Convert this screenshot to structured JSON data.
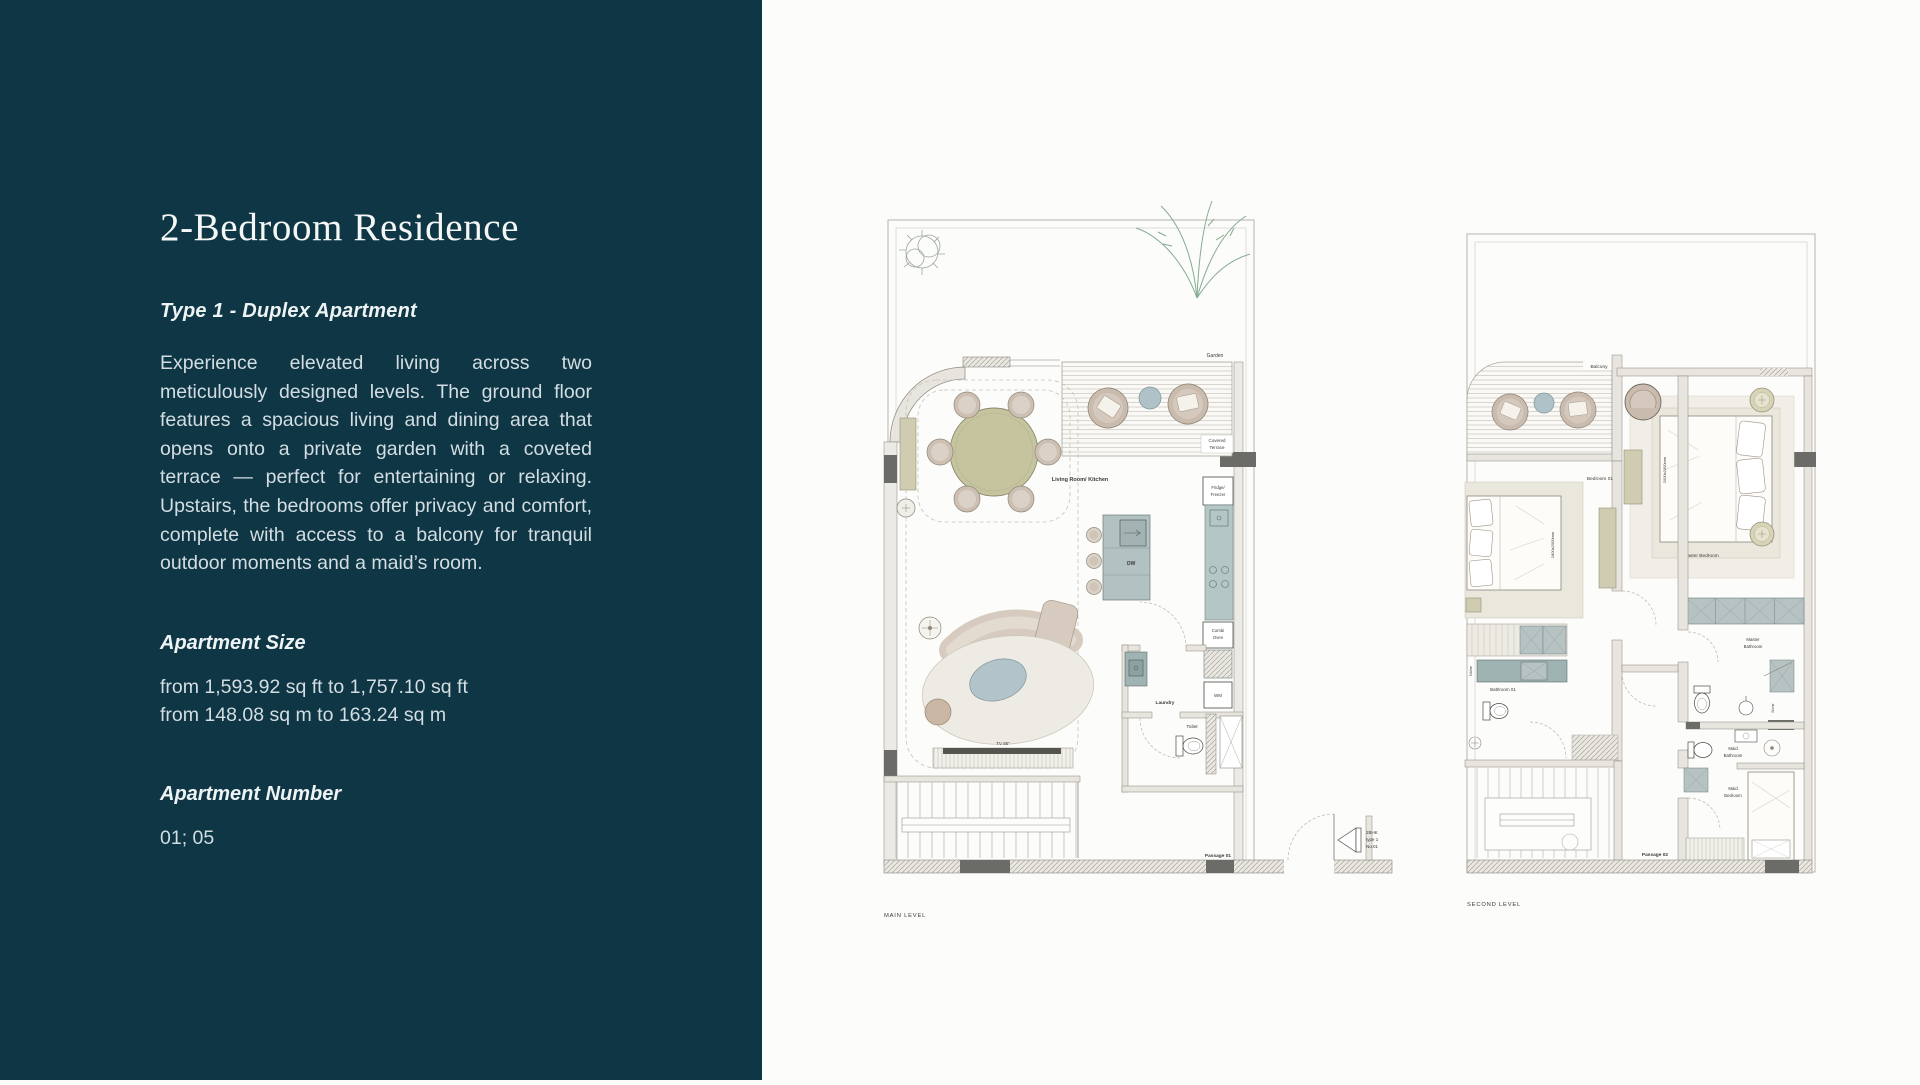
{
  "sidebar": {
    "title": "2-Bedroom Residence",
    "subtitle": "Type 1 - Duplex Apartment",
    "description": "Experience elevated living across two meticulously designed levels. The ground floor features a spacious living and dining area that opens onto a private garden with a coveted terrace — perfect for entertaining or relaxing. Upstairs, the bedrooms offer privacy and comfort, complete with access to a balcony for tranquil outdoor moments and a maid’s room.",
    "size_heading": "Apartment Size",
    "size_imperial": "from 1,593.92 sq ft to 1,757.10 sq ft",
    "size_metric": "from 148.08 sq m to 163.24 sq m",
    "number_heading": "Apartment Number",
    "number_value": "01; 05",
    "bg_color": "#0e3645",
    "text_color": "#d3dde2"
  },
  "plans": {
    "main": {
      "caption": "MAIN LEVEL",
      "labels": {
        "garden": "Garden",
        "covered_terrace": [
          "Covered",
          "Terrace"
        ],
        "living": "Living Room/ Kitchen",
        "fridge": [
          "Fridge/",
          "Freezer"
        ],
        "dw": "DW",
        "combi": [
          "Combi",
          "Oven"
        ],
        "wm": "WM",
        "laundry": "Laundry",
        "toilet": "Toilet",
        "tv": "TV 85\"",
        "passage": "Passage 01",
        "unit": [
          "2BHK",
          "type 1",
          "No.01"
        ]
      }
    },
    "second": {
      "caption": "SECOND LEVEL",
      "labels": {
        "balcony": "Balcony",
        "bedroom01": "Bedroom 01",
        "master_bedroom": "Master Bedroom",
        "master_bathroom": [
          "Master",
          "Bathroom"
        ],
        "bathroom01": "Bathroom 01",
        "niche": "Niche",
        "maid_bathroom": [
          "Maid",
          "Bathroom"
        ],
        "maid_bedroom": [
          "Maid",
          "Bedroom"
        ],
        "passage": "Passage 02",
        "bed_master_dim": "2000x2000mm",
        "bed01_dim": "1800x2000mm"
      }
    }
  }
}
